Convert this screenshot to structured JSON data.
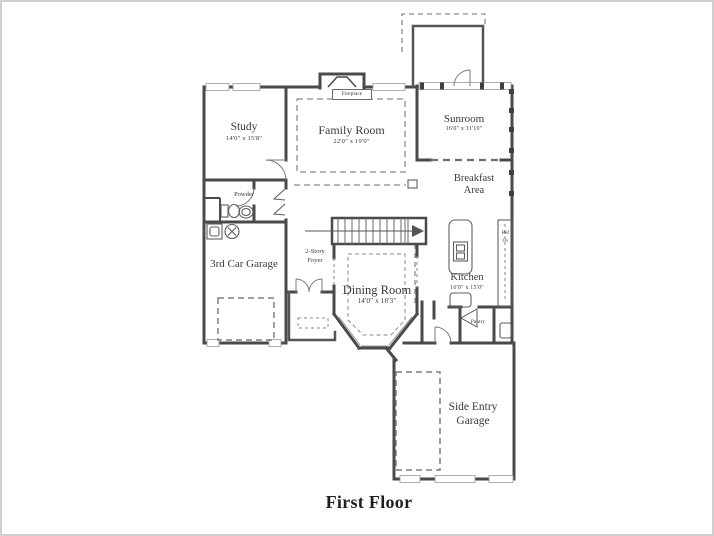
{
  "title": "First Floor",
  "rooms": {
    "study": {
      "name": "Study",
      "dims": "14'0\" x 15'8\""
    },
    "family_room": {
      "name": "Family Room",
      "dims": "22'0\" x 19'0\""
    },
    "sunroom": {
      "name": "Sunroom",
      "dims": "16'0\" x 11'10\""
    },
    "breakfast": {
      "line1": "Breakfast",
      "line2": "Area"
    },
    "kitchen": {
      "name": "Kitchen",
      "dims": "16'0\" x 15'0\""
    },
    "dining_room": {
      "name": "Dining Room",
      "dims": "14'0\" x 18'3\""
    },
    "garage_3rd": {
      "name": "3rd Car Garage"
    },
    "side_garage": {
      "line1": "Side Entry",
      "line2": "Garage"
    },
    "powder": {
      "name": "Powder"
    },
    "pantry": {
      "name": "Pantry"
    },
    "foyer": {
      "line1": "2-Story",
      "line2": "Foyer"
    },
    "fireplace": {
      "name": "Fireplace"
    }
  },
  "appliances": {
    "ref": "Ref",
    "oven": "Ov"
  },
  "colors": {
    "wall": "#4a4a4a",
    "thin_line": "#6a6a6a",
    "dashed": "#8a8a8a",
    "text": "#3a3a3a",
    "border": "#cfcfcf"
  }
}
